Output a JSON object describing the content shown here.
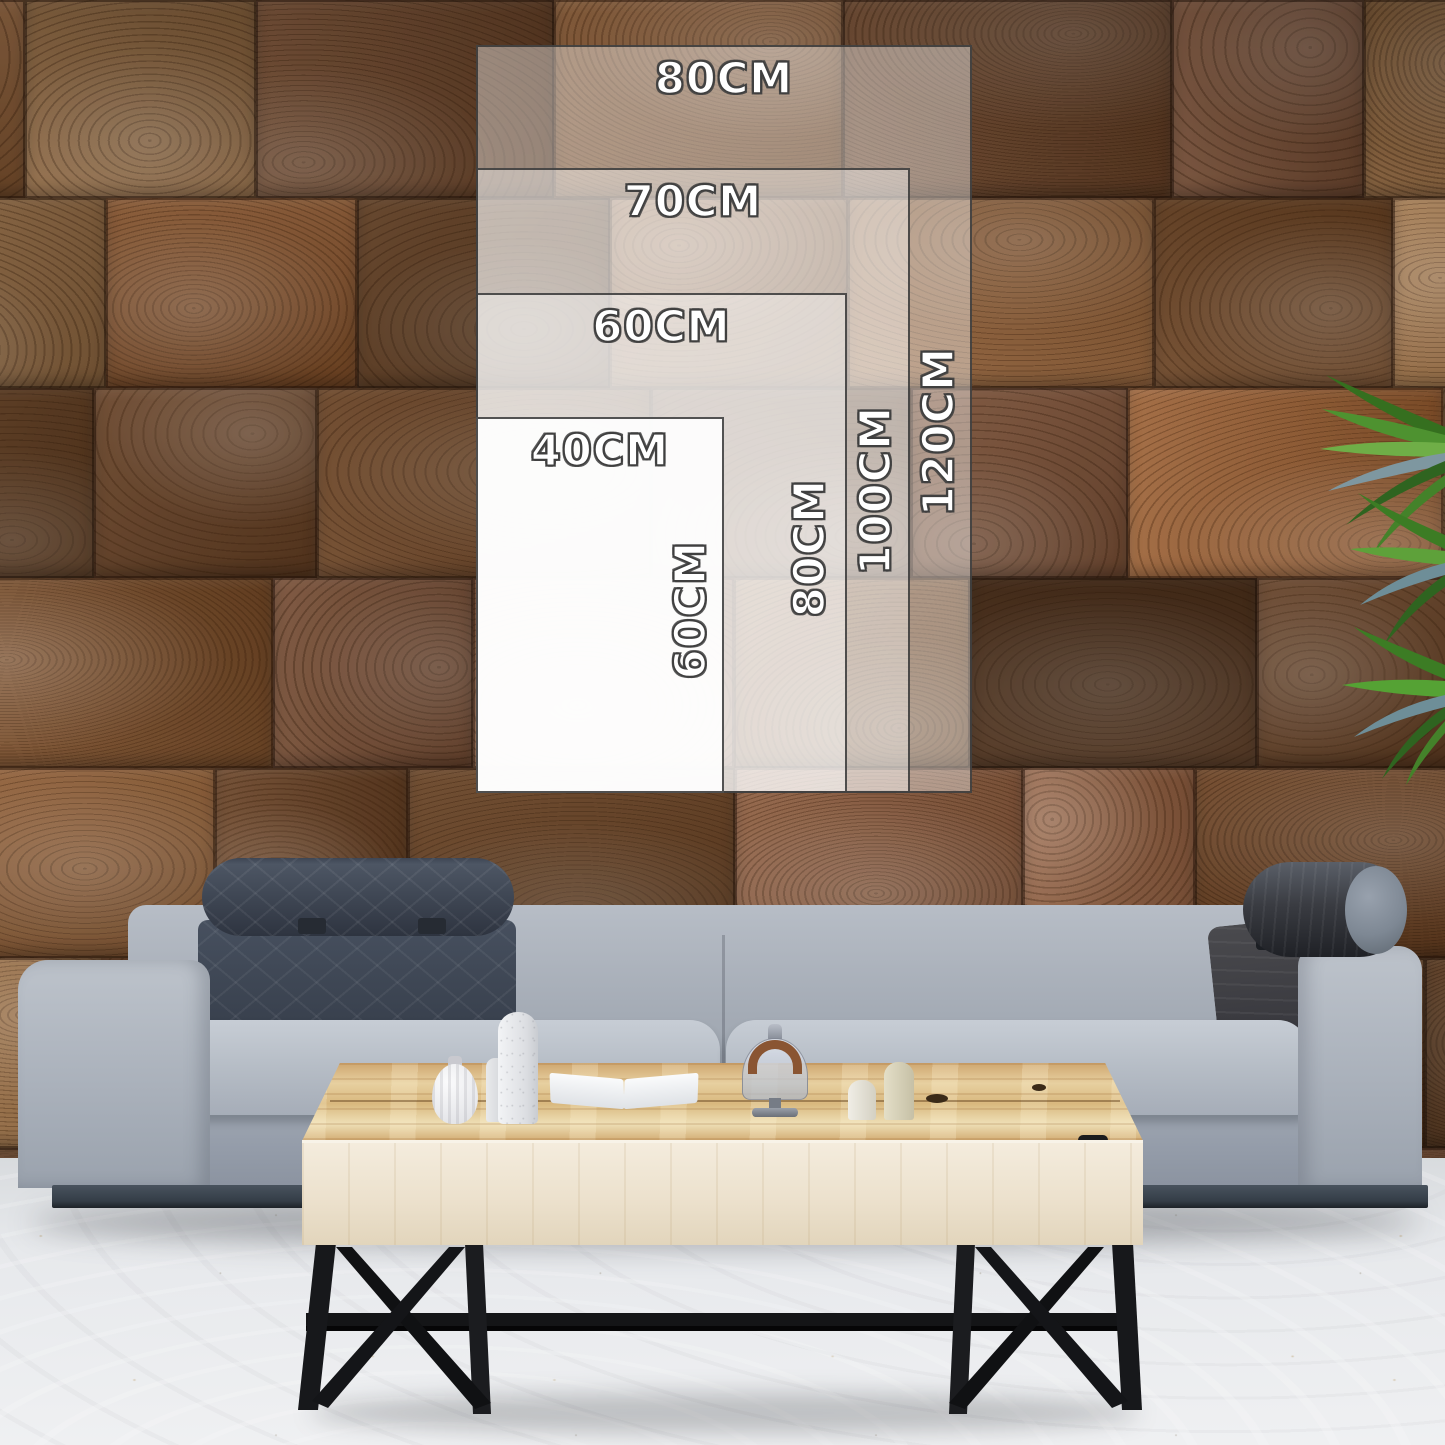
{
  "size_guide": {
    "unit": "CM",
    "sizes": [
      {
        "name": "80x120",
        "width_label": "80CM",
        "height_label": "120CM",
        "width_cm": 80,
        "height_cm": 120
      },
      {
        "name": "70x100",
        "width_label": "70CM",
        "height_label": "100CM",
        "width_cm": 70,
        "height_cm": 100
      },
      {
        "name": "60x80",
        "width_label": "60CM",
        "height_label": "80CM",
        "width_cm": 60,
        "height_cm": 80
      },
      {
        "name": "40x60",
        "width_label": "40CM",
        "height_label": "60CM",
        "width_cm": 40,
        "height_cm": 60
      }
    ]
  },
  "colors": {
    "wood_palette": [
      "#7b4b27",
      "#8a5a33",
      "#6b4323",
      "#96683c",
      "#5d3a20",
      "#84563a",
      "#9a6f45",
      "#74492b"
    ],
    "label_text": "#ffffff",
    "label_outline": "#3f3f3f",
    "overlay_border": "#343434",
    "sofa_fabric": "#b0b7c0",
    "headrest_dark": "#3e4654",
    "table_wood": "#ddbd89",
    "floor": "#e9ebee",
    "plant_green": "#4e8f2e"
  }
}
